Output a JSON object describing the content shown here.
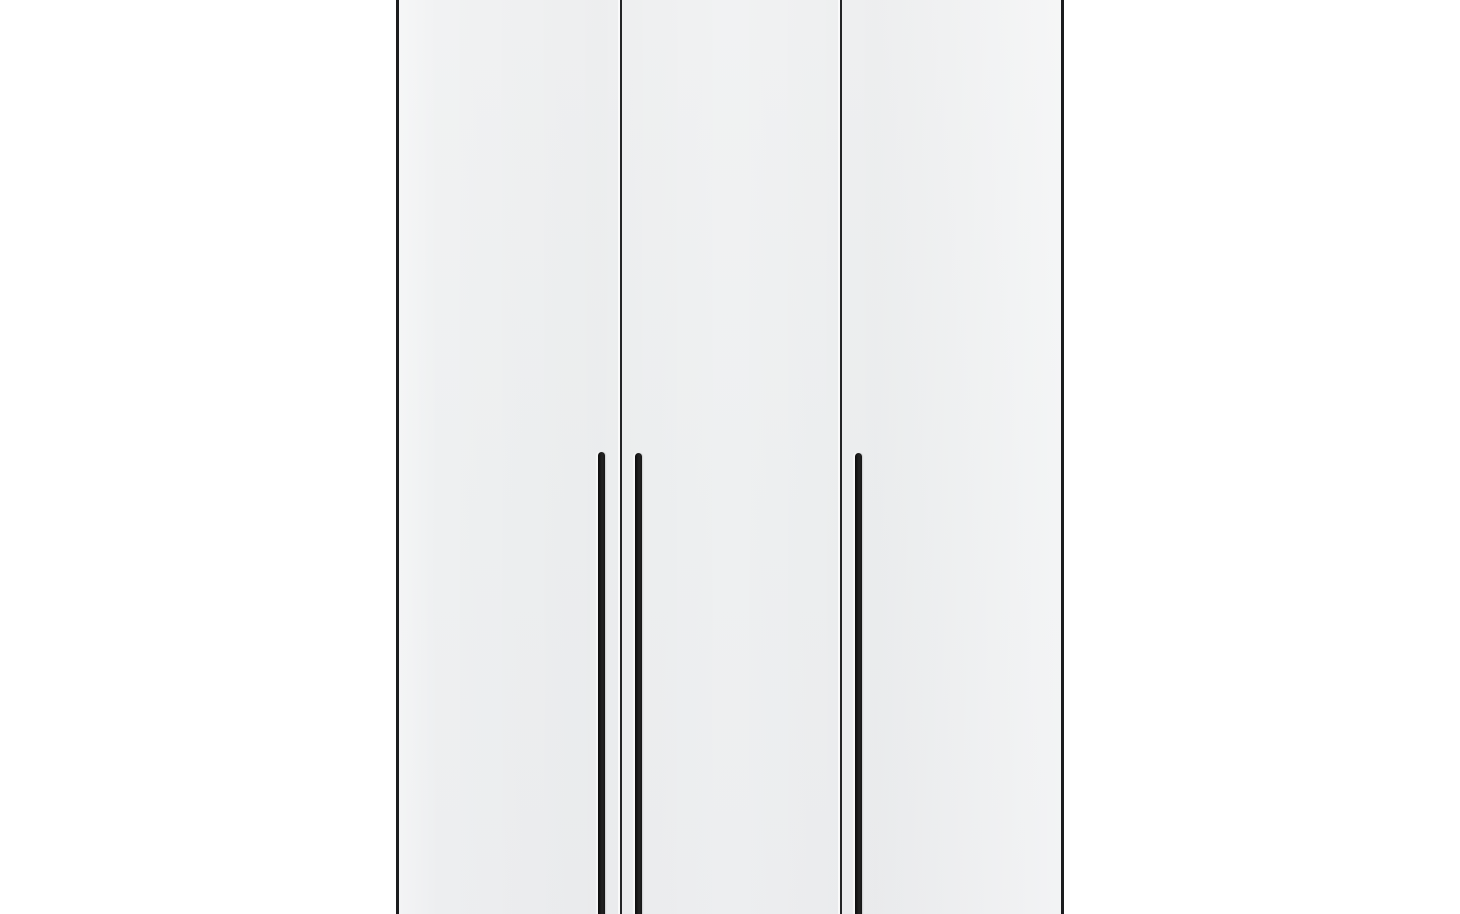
{
  "image": {
    "type": "product-photo",
    "subject": "three-door wardrobe, front view, cropped at top and bottom of frame",
    "background_color": "#ffffff",
    "panel_color": "#eef0f1",
    "trim_color": "#1b1c1e",
    "handle_color": "#141414",
    "doors": [
      {
        "label": "left-door",
        "handle": "long vertical bar handle near right edge of door"
      },
      {
        "label": "middle-door",
        "handle": "long vertical bar handle near left edge of door"
      },
      {
        "label": "right-door",
        "handle": "long vertical bar handle near left edge of door"
      }
    ],
    "handle_count": 3,
    "visible_text": ""
  }
}
